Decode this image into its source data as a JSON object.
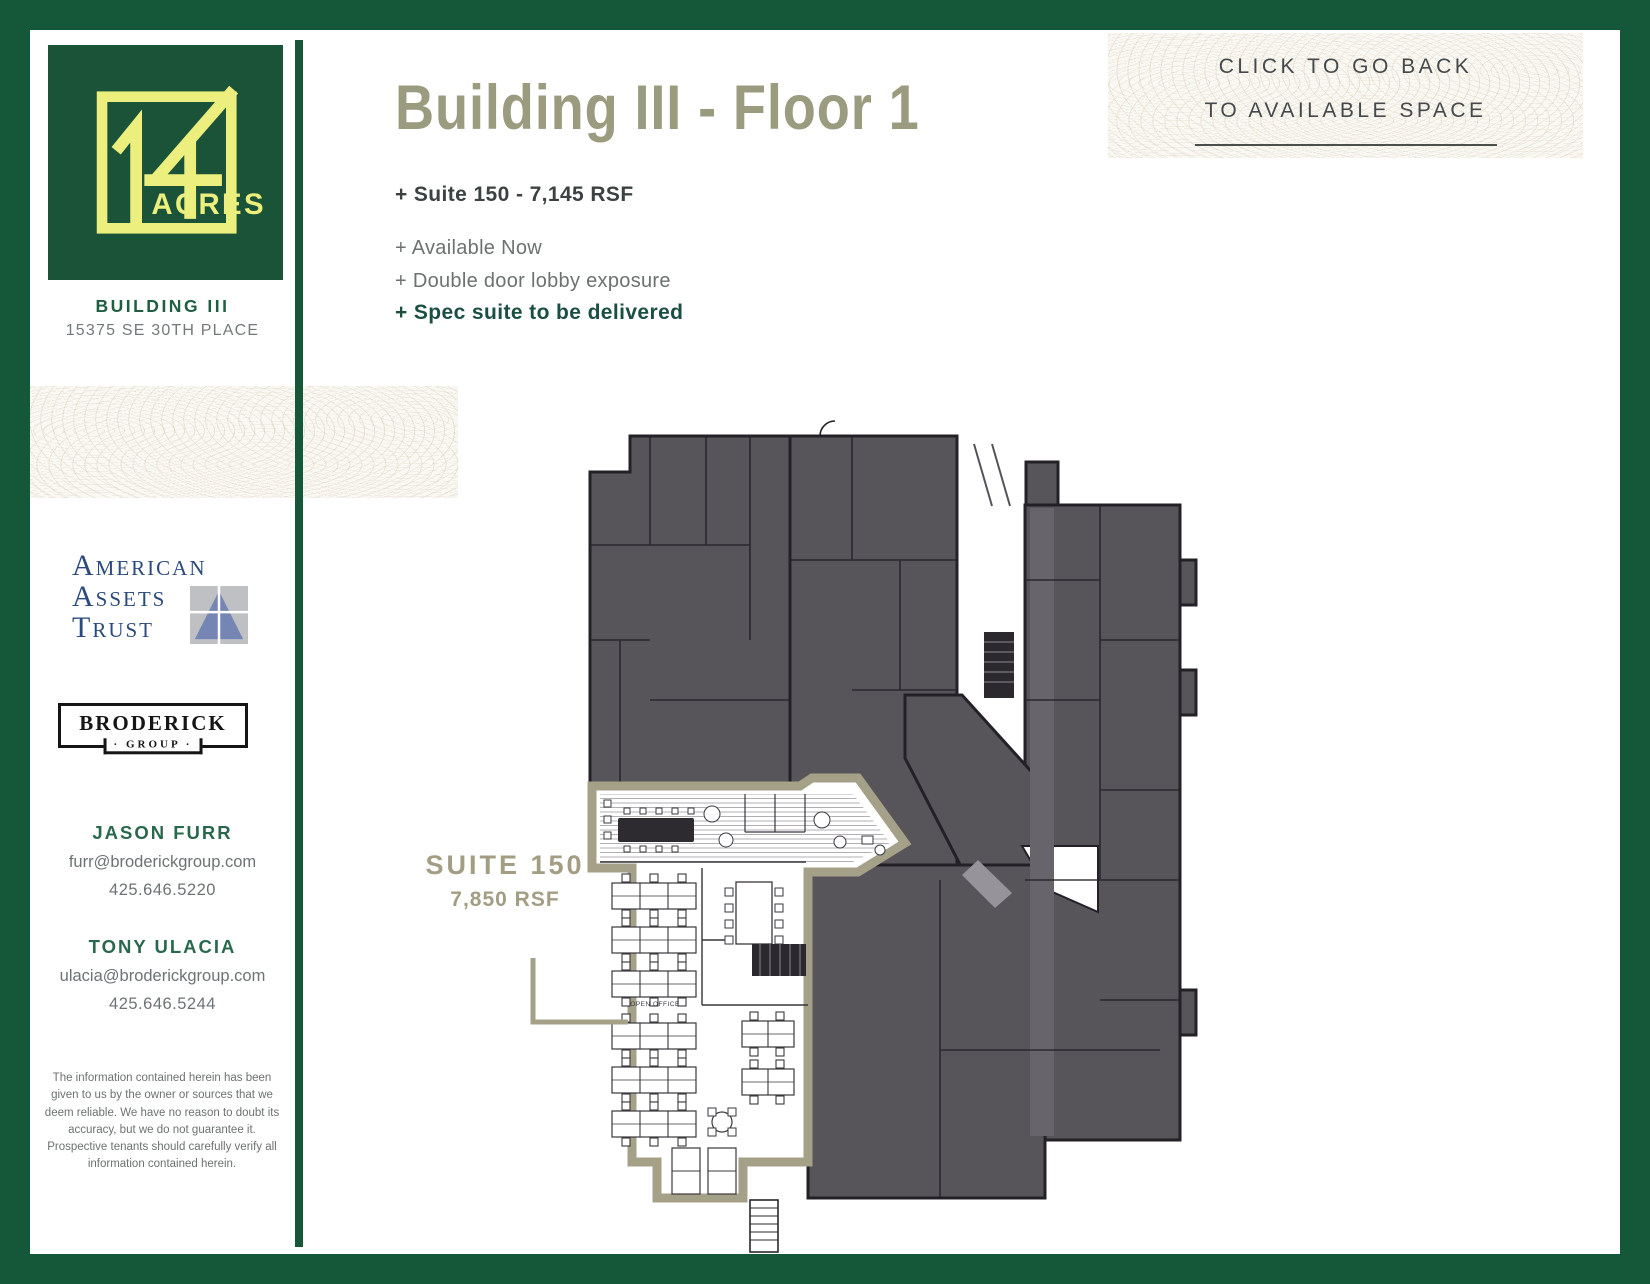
{
  "colors": {
    "frame_green": "#155839",
    "accent_green": "#1b4f42",
    "title_tan": "#9b9b80",
    "suite_outline_tan": "#a5a088",
    "plan_mass_gray": "#57545a",
    "logo_yellow": "#ecef7d",
    "aat_navy": "#2b4a7d"
  },
  "sidebar": {
    "logo": {
      "numeral": "14",
      "acres": "ACRES",
      "brand": "14 ACRES"
    },
    "building_name": "BUILDING III",
    "address": "15375 SE 30TH PLACE",
    "aat_logo": {
      "line1": "American",
      "line2": "Assets",
      "line3": "Trust"
    },
    "broderick_logo": {
      "name": "BRODERICK",
      "group": "· GROUP ·"
    },
    "contacts": [
      {
        "name": "JASON FURR",
        "email": "furr@broderickgroup.com",
        "phone": "425.646.5220"
      },
      {
        "name": "TONY ULACIA",
        "email": "ulacia@broderickgroup.com",
        "phone": "425.646.5244"
      }
    ],
    "disclaimer": "The information contained herein has been given to us by the owner or sources that we deem reliable. We have no reason to doubt its accuracy, but we do not guarantee it. Prospective tenants should carefully verify all information contained herein."
  },
  "header": {
    "title": "Building III - Floor 1",
    "bullets": [
      {
        "text": "+ Suite 150 - 7,145 RSF",
        "style": "bold-dark"
      },
      {
        "text": "+ Available Now",
        "style": "gray"
      },
      {
        "text": "+ Double door lobby exposure",
        "style": "gray"
      },
      {
        "text": "+ Spec suite to be delivered",
        "style": "bold-green"
      }
    ],
    "back_link": {
      "line1": "CLICK TO GO BACK",
      "line2": "TO AVAILABLE SPACE"
    }
  },
  "floorplan": {
    "suite_label": "SUITE 150",
    "suite_rsf": "7,850 RSF",
    "open_office_label": "OPEN OFFICE"
  }
}
